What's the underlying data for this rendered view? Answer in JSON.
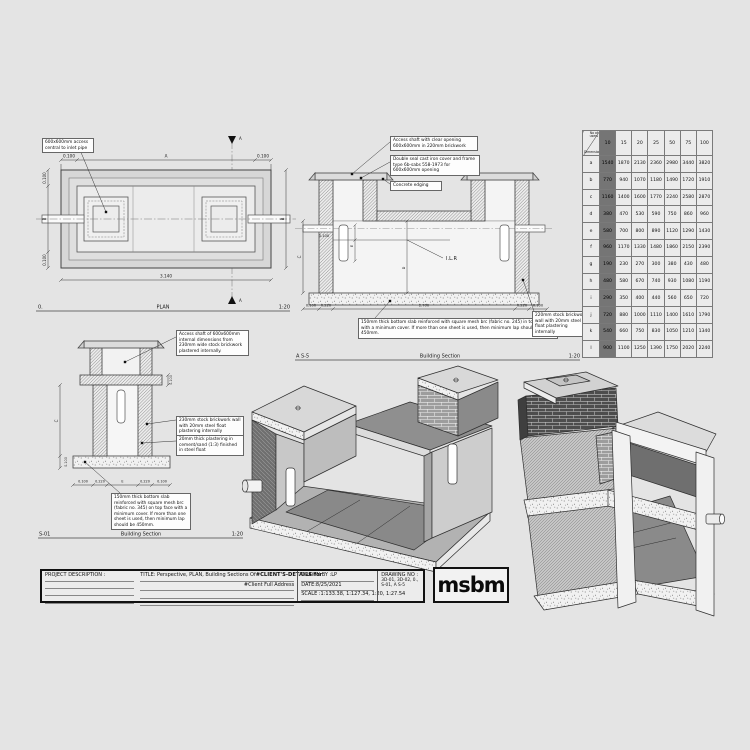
{
  "sheet": {
    "background": "#e4e4e4",
    "line_color": "#333333",
    "highlight_gray": "#757575"
  },
  "plan": {
    "ref_no": "0.",
    "label": "PLAN",
    "scale": "1:20",
    "annotation_access": "600x600mm access central to inlet pipe",
    "dim_top_left": "0.100",
    "dim_top_mid": "A",
    "dim_top_right": "0.100",
    "dim_bottom": "3.140",
    "dim_left_top": "0.100",
    "dim_left_mid": "B",
    "dim_left_bottom": "0.100",
    "dim_right": "B",
    "section_marker": "A"
  },
  "section_as5": {
    "ref_no": "A S-5",
    "label": "Building Section",
    "scale": "1:20",
    "anno_access_shaft": "Access shaft with clear opening 600x600mm in 220mm brickwork",
    "anno_cover": "Double seal cast iron cover and frame type 6b-sabs 558-1973 for 600x600mm opening",
    "anno_edging": "Concrete edging",
    "anno_slab": "150mm thick bottom slab reinforced with square mesh brc (fabric no. 245) in top face with a minimum cover. If more than one sheet is used, then minimum lap should be 450mm.",
    "anno_wall": "220mm stock brickwork wall with 20mm steel float plastering internally",
    "label_ilr": "I.L.R",
    "dim_bottom": [
      "0.100",
      "0.220",
      "2.700",
      "0.220",
      "0.100"
    ],
    "dim_left": "C",
    "dim_inner_mid": "D",
    "dim_inner_top": "E",
    "dim_pipe": "0.100"
  },
  "section_s01": {
    "ref_no": "S-01",
    "label": "Building Section",
    "scale": "1:20",
    "anno_access_shaft": "Access shaft of 600x600mm internal dimensions from 230mm wide stock brickwork plastered internally.",
    "anno_wall": "230mm stock brickwork wall with 20mm steel float plastering internally",
    "anno_plaster": "20mm thick plastering in cement/sand (1:3) finished in steel float",
    "anno_slab": "150mm thick bottom slab reinforced with square mesh brc (fabric no. 345) on top face with a minimum cover. If more than one sheet is used, then minimum lap should be 450mm.",
    "dim_bottom": [
      "0.100",
      "0.220",
      "E",
      "0.220",
      "0.100"
    ],
    "dim_left": "C",
    "dim_left_small": "0.100",
    "dim_right_small": "0.100"
  },
  "sizing_table": {
    "corner_top": "No of users",
    "corner_bottom": "Dimensions",
    "columns": [
      "10",
      "15",
      "20",
      "25",
      "50",
      "75",
      "100"
    ],
    "rows": [
      {
        "label": "a",
        "values": [
          "1540",
          "1870",
          "2130",
          "2360",
          "2980",
          "3440",
          "3820"
        ]
      },
      {
        "label": "b",
        "values": [
          "770",
          "940",
          "1070",
          "1180",
          "1490",
          "1720",
          "1910"
        ]
      },
      {
        "label": "c",
        "values": [
          "1160",
          "1400",
          "1600",
          "1770",
          "2240",
          "2580",
          "2870"
        ]
      },
      {
        "label": "d",
        "values": [
          "380",
          "470",
          "530",
          "590",
          "750",
          "860",
          "960"
        ]
      },
      {
        "label": "e",
        "values": [
          "580",
          "700",
          "800",
          "890",
          "1120",
          "1290",
          "1430"
        ]
      },
      {
        "label": "f",
        "values": [
          "960",
          "1170",
          "1330",
          "1480",
          "1860",
          "2150",
          "2390"
        ]
      },
      {
        "label": "g",
        "values": [
          "190",
          "230",
          "270",
          "300",
          "380",
          "430",
          "480"
        ]
      },
      {
        "label": "h",
        "values": [
          "480",
          "580",
          "670",
          "740",
          "930",
          "1080",
          "1190"
        ]
      },
      {
        "label": "i",
        "values": [
          "290",
          "350",
          "400",
          "440",
          "560",
          "650",
          "720"
        ]
      },
      {
        "label": "j",
        "values": [
          "720",
          "880",
          "1000",
          "1110",
          "1400",
          "1610",
          "1790"
        ]
      },
      {
        "label": "k",
        "values": [
          "540",
          "660",
          "750",
          "830",
          "1050",
          "1210",
          "1340"
        ]
      },
      {
        "label": "l",
        "values": [
          "900",
          "1100",
          "1250",
          "1390",
          "1750",
          "2020",
          "2240"
        ]
      }
    ]
  },
  "title_block": {
    "project_label": "PROJECT DESCRIPTION :",
    "title_normal": "TITLE: Perspective, PLAN, Building Sections Of",
    "title_bold": "#CLIENT'S-DETAILS for",
    "client_address": "#Client Full Address",
    "drawn_by": "DRAWN BY :LP",
    "date": "DATE:8/25/2021",
    "scale": "SCALE :1:133.38, 1:127.34, 1:20, 1:27.54",
    "drawing_no_label": "DRAWING NO :",
    "drawing_no": "3D-01, 3D-02, 0., S-01, A S-5"
  },
  "logo_text": "msbm"
}
